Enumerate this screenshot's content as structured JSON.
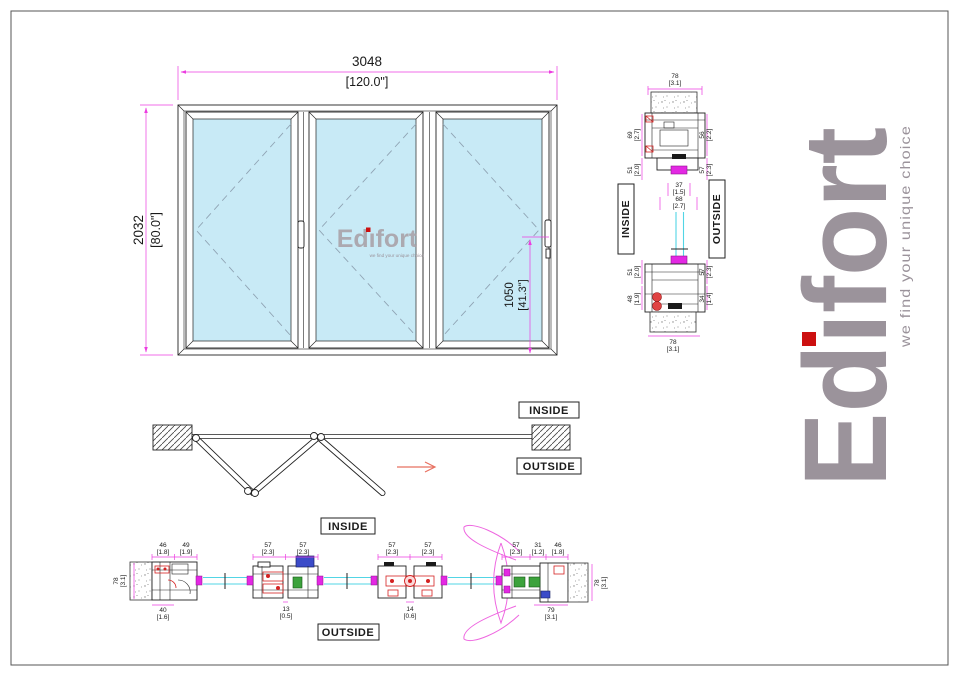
{
  "brand": {
    "name": "Edifort",
    "tagline": "we find your unique choice",
    "gray": "#9B939B",
    "red": "#CC1010"
  },
  "watermark": {
    "name": "Edifort",
    "tagline": "we find your unique choice"
  },
  "colors": {
    "dimension": "#EC3CE0",
    "glass_fill": "#C8EAF6",
    "glass_edge": "#52D5E5",
    "gasket": "#E328E3",
    "hardware_red": "#D42222",
    "hardware_blue": "#3B4BC8",
    "hardware_green": "#3CA23C"
  },
  "elev": {
    "w_mm": "3048",
    "w_in": "[120.0\"]",
    "h_mm": "2032",
    "h_in": "[80.0\"]",
    "hd_mm": "1050",
    "hd_in": "[41.3\"]"
  },
  "vsec": {
    "inside": "INSIDE",
    "outside": "OUTSIDE",
    "head_top_mm": "78",
    "head_top_in": "[3.1]",
    "head_l1_mm": "69",
    "head_l1_in": "[2.7]",
    "head_l2_mm": "51",
    "head_l2_in": "[2.0]",
    "head_r1_mm": "56",
    "head_r1_in": "[2.2]",
    "head_r2_mm": "57",
    "head_r2_in": "[2.3]",
    "head_b1_mm": "37",
    "head_b1_in": "[1.5]",
    "head_b2_mm": "68",
    "head_b2_in": "[2.7]",
    "sill_l1_mm": "51",
    "sill_l1_in": "[2.0]",
    "sill_l2_mm": "48",
    "sill_l2_in": "[1.9]",
    "sill_r1_mm": "57",
    "sill_r1_in": "[2.3]",
    "sill_r2_mm": "34",
    "sill_r2_in": "[1.4]",
    "sill_b_mm": "78",
    "sill_b_in": "[3.1]"
  },
  "plan": {
    "inside": "INSIDE",
    "outside": "OUTSIDE"
  },
  "hsec": {
    "inside": "INSIDE",
    "outside": "OUTSIDE",
    "lj_t1_mm": "46",
    "lj_t1_in": "[1.8]",
    "lj_t2_mm": "49",
    "lj_t2_in": "[1.9]",
    "lj_d_mm": "78",
    "lj_d_in": "[3.1]",
    "lj_b_mm": "40",
    "lj_b_in": "[1.6]",
    "m1_t1_mm": "57",
    "m1_t1_in": "[2.3]",
    "m1_t2_mm": "57",
    "m1_t2_in": "[2.3]",
    "m1_b_mm": "13",
    "m1_b_in": "[0.5]",
    "m2_t1_mm": "57",
    "m2_t1_in": "[2.3]",
    "m2_t2_mm": "57",
    "m2_t2_in": "[2.3]",
    "m2_b_mm": "14",
    "m2_b_in": "[0.6]",
    "rj_t1_mm": "57",
    "rj_t1_in": "[2.3]",
    "rj_t2_mm": "31",
    "rj_t2_in": "[1.2]",
    "rj_t3_mm": "46",
    "rj_t3_in": "[1.8]",
    "rj_d_mm": "78",
    "rj_d_in": "[3.1]",
    "rj_b_mm": "79",
    "rj_b_in": "[3.1]"
  }
}
